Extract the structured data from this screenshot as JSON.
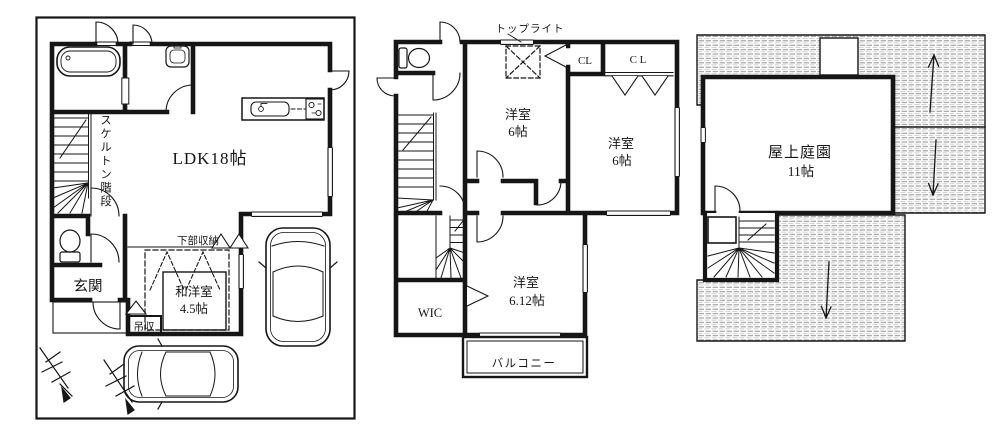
{
  "colors": {
    "line": "#161616",
    "hatch": "#8f8f8f",
    "paper": "#ffffff"
  },
  "floor1": {
    "ldk": "LDK18帖",
    "skeleton_stairs": "スケルトン階段",
    "entrance": "玄関",
    "lower_storage": "下部収納",
    "hanging_storage": "吊収",
    "washitsu_name": "和洋室",
    "washitsu_size": "4.5帖"
  },
  "floor2": {
    "toplight": "トップライト",
    "bedroom_center_name": "洋室",
    "bedroom_center_size": "6帖",
    "closet_small": "CL",
    "closet_large": "C L",
    "bedroom_right_name": "洋室",
    "bedroom_right_size": "6帖",
    "wic": "WIC",
    "bedroom_main_name": "洋室",
    "bedroom_main_size": "6.12帖",
    "balcony": "バルコニー"
  },
  "roof": {
    "garden_name": "屋上庭園",
    "garden_size": "11帖"
  }
}
